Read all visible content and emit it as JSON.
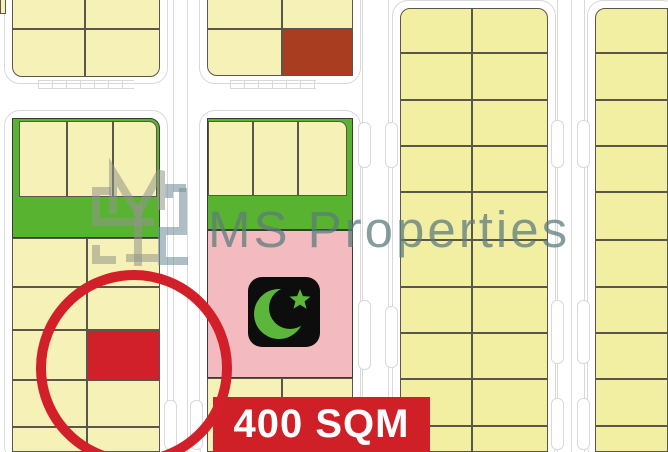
{
  "canvas": {
    "width": 668,
    "height": 452,
    "background": "#ffffff"
  },
  "watermark": {
    "text": "MS Properties"
  },
  "badge": {
    "label": "400 SQM"
  },
  "icons": [
    {
      "name": "crescent-star-icon",
      "meaning": "mosque plot marker"
    },
    {
      "name": "highlight-circle",
      "meaning": "red circle marking advertised plot"
    }
  ],
  "colors": {
    "yellowL": "#f6f1b6",
    "yellowR": "#f2efa3",
    "green": "#58b331",
    "brown": "#a93d1f",
    "pink": "#f3bac0",
    "red": "#d2202a",
    "banner_red": "#ce2026",
    "plot_border": "#5a564c",
    "block_border": "#3e3b33",
    "street_line": "#d9d9d9",
    "watermark_text": "rgba(93,124,124,0.75)",
    "logo_gray": "rgba(146,148,136,0.55)",
    "logo_steel": "rgba(118,146,158,0.6)",
    "icon_black": "#0d0d0d",
    "icon_green": "#5cb63c",
    "white": "#ffffff"
  },
  "map": {
    "street_outlines": [
      {
        "x": 4,
        "y": -22,
        "w": 164,
        "h": 106
      },
      {
        "x": 199,
        "y": -22,
        "w": 162,
        "h": 106
      },
      {
        "x": 4,
        "y": 110,
        "w": 164,
        "h": 352
      },
      {
        "x": 199,
        "y": 110,
        "w": 162,
        "h": 352
      },
      {
        "x": 392,
        "y": 0,
        "w": 164,
        "h": 462
      },
      {
        "x": 587,
        "y": 0,
        "w": 92,
        "h": 462
      }
    ],
    "street_vlines": [
      {
        "x": 173,
        "y": 0,
        "h": 452
      },
      {
        "x": 187,
        "y": 0,
        "h": 452
      },
      {
        "x": 362,
        "y": 0,
        "h": 452
      },
      {
        "x": 388,
        "y": 0,
        "h": 452
      },
      {
        "x": 557,
        "y": 0,
        "h": 452
      },
      {
        "x": 571,
        "y": 0,
        "h": 452
      },
      {
        "x": 584,
        "y": 0,
        "h": 452
      }
    ],
    "tick_strips": [
      {
        "x": 38,
        "y": 80,
        "w": 96,
        "h": 9
      },
      {
        "x": 230,
        "y": 80,
        "w": 86,
        "h": 9
      }
    ],
    "street_bays": [
      {
        "x": 551,
        "y": 120,
        "w": 13,
        "h": 48
      },
      {
        "x": 577,
        "y": 120,
        "w": 13,
        "h": 48
      },
      {
        "x": 551,
        "y": 300,
        "w": 13,
        "h": 64
      },
      {
        "x": 577,
        "y": 300,
        "w": 13,
        "h": 64
      },
      {
        "x": 551,
        "y": 398,
        "w": 13,
        "h": 52
      },
      {
        "x": 577,
        "y": 398,
        "w": 13,
        "h": 52
      },
      {
        "x": 358,
        "y": 300,
        "w": 13,
        "h": 70
      },
      {
        "x": 385,
        "y": 306,
        "w": 13,
        "h": 62
      },
      {
        "x": 358,
        "y": 122,
        "w": 13,
        "h": 46
      },
      {
        "x": 385,
        "y": 122,
        "w": 13,
        "h": 46
      },
      {
        "x": 164,
        "y": 400,
        "w": 13,
        "h": 50
      },
      {
        "x": 190,
        "y": 400,
        "w": 13,
        "h": 50
      }
    ],
    "blocks": [
      {
        "name": "edge-sliver-block",
        "plots": [
          {
            "x": 0,
            "y": -6,
            "w": 6,
            "h": 20,
            "c": "yellowL"
          }
        ]
      },
      {
        "name": "top-left-block",
        "plots": [
          {
            "x": 12,
            "y": -16,
            "w": 73,
            "h": 45,
            "c": "yellowL"
          },
          {
            "x": 85,
            "y": -16,
            "w": 75,
            "h": 45,
            "c": "yellowL"
          },
          {
            "x": 12,
            "y": 29,
            "w": 73,
            "h": 48,
            "c": "yellowL",
            "r": "0 0 0 10px"
          },
          {
            "x": 85,
            "y": 29,
            "w": 75,
            "h": 48,
            "c": "yellowL",
            "r": "0 0 10px 0"
          }
        ]
      },
      {
        "name": "top-middle-block",
        "plots": [
          {
            "x": 207,
            "y": -16,
            "w": 75,
            "h": 45,
            "c": "yellowL"
          },
          {
            "x": 282,
            "y": -16,
            "w": 71,
            "h": 45,
            "c": "yellowL"
          },
          {
            "x": 207,
            "y": 29,
            "w": 75,
            "h": 47,
            "c": "yellowL",
            "r": "0 0 0 10px"
          },
          {
            "x": 282,
            "y": 29,
            "w": 71,
            "h": 47,
            "c": "brown",
            "name": "sold-plot"
          }
        ]
      },
      {
        "name": "left-green-block",
        "bases": [
          {
            "x": 12,
            "y": 118,
            "w": 148,
            "h": 120,
            "c": "green",
            "r": "0 10px 0 0",
            "name": "green-strip"
          }
        ],
        "plots": [
          {
            "x": 19,
            "y": 121,
            "w": 48,
            "h": 76,
            "c": "yellowL"
          },
          {
            "x": 67,
            "y": 121,
            "w": 46,
            "h": 76,
            "c": "yellowL"
          },
          {
            "x": 113,
            "y": 121,
            "w": 44,
            "h": 76,
            "c": "yellowL",
            "r": "0 8px 0 0"
          }
        ]
      },
      {
        "name": "left-bottom-block",
        "plots": [
          {
            "x": 12,
            "y": 238,
            "w": 75,
            "h": 49,
            "c": "yellowL"
          },
          {
            "x": 87,
            "y": 238,
            "w": 73,
            "h": 49,
            "c": "yellowL"
          },
          {
            "x": 12,
            "y": 287,
            "w": 75,
            "h": 43,
            "c": "yellowL"
          },
          {
            "x": 87,
            "y": 287,
            "w": 73,
            "h": 43,
            "c": "yellowL"
          },
          {
            "x": 12,
            "y": 330,
            "w": 75,
            "h": 50,
            "c": "yellowL"
          },
          {
            "x": 87,
            "y": 330,
            "w": 73,
            "h": 50,
            "c": "red",
            "name": "highlighted-plot"
          },
          {
            "x": 12,
            "y": 380,
            "w": 75,
            "h": 47,
            "c": "yellowL"
          },
          {
            "x": 87,
            "y": 380,
            "w": 73,
            "h": 47,
            "c": "yellowL"
          },
          {
            "x": 12,
            "y": 427,
            "w": 75,
            "h": 25,
            "c": "yellowL"
          },
          {
            "x": 87,
            "y": 427,
            "w": 73,
            "h": 25,
            "c": "yellowL"
          }
        ]
      },
      {
        "name": "mosque-block",
        "bases": [
          {
            "x": 207,
            "y": 118,
            "w": 146,
            "h": 112,
            "c": "green",
            "name": "green-strip"
          },
          {
            "x": 207,
            "y": 230,
            "w": 146,
            "h": 148,
            "c": "pink",
            "name": "mosque-area"
          }
        ],
        "plots": [
          {
            "x": 208,
            "y": 121,
            "w": 45,
            "h": 75,
            "c": "yellowL"
          },
          {
            "x": 253,
            "y": 121,
            "w": 45,
            "h": 75,
            "c": "yellowL"
          },
          {
            "x": 298,
            "y": 121,
            "w": 49,
            "h": 75,
            "c": "yellowL",
            "r": "0 8px 0 0"
          }
        ]
      },
      {
        "name": "middle-bottom-block",
        "plots": [
          {
            "x": 207,
            "y": 378,
            "w": 75,
            "h": 74,
            "c": "yellowL"
          },
          {
            "x": 282,
            "y": 378,
            "w": 71,
            "h": 74,
            "c": "yellowL"
          }
        ]
      },
      {
        "name": "mid-right-block",
        "grid": {
          "cols": [
            [
              400,
              72
            ],
            [
              472,
              76
            ]
          ],
          "rows": [
            [
              8,
              45
            ],
            [
              53,
              47
            ],
            [
              100,
              46
            ],
            [
              146,
              46
            ],
            [
              192,
              48
            ],
            [
              240,
              47
            ],
            [
              287,
              46
            ],
            [
              333,
              46
            ],
            [
              379,
              47
            ],
            [
              426,
              26
            ]
          ],
          "c": "yellowR",
          "r0": [
            "10px 0 0 0",
            "0 10px 0 0"
          ]
        }
      },
      {
        "name": "far-right-block",
        "grid": {
          "cols": [
            [
              595,
              73
            ]
          ],
          "rows": [
            [
              8,
              45
            ],
            [
              53,
              47
            ],
            [
              100,
              46
            ],
            [
              146,
              46
            ],
            [
              192,
              48
            ],
            [
              240,
              47
            ],
            [
              287,
              46
            ],
            [
              333,
              46
            ],
            [
              379,
              47
            ],
            [
              426,
              26
            ]
          ],
          "c": "yellowR",
          "r0": [
            "10px 0 0 0"
          ]
        }
      }
    ]
  }
}
